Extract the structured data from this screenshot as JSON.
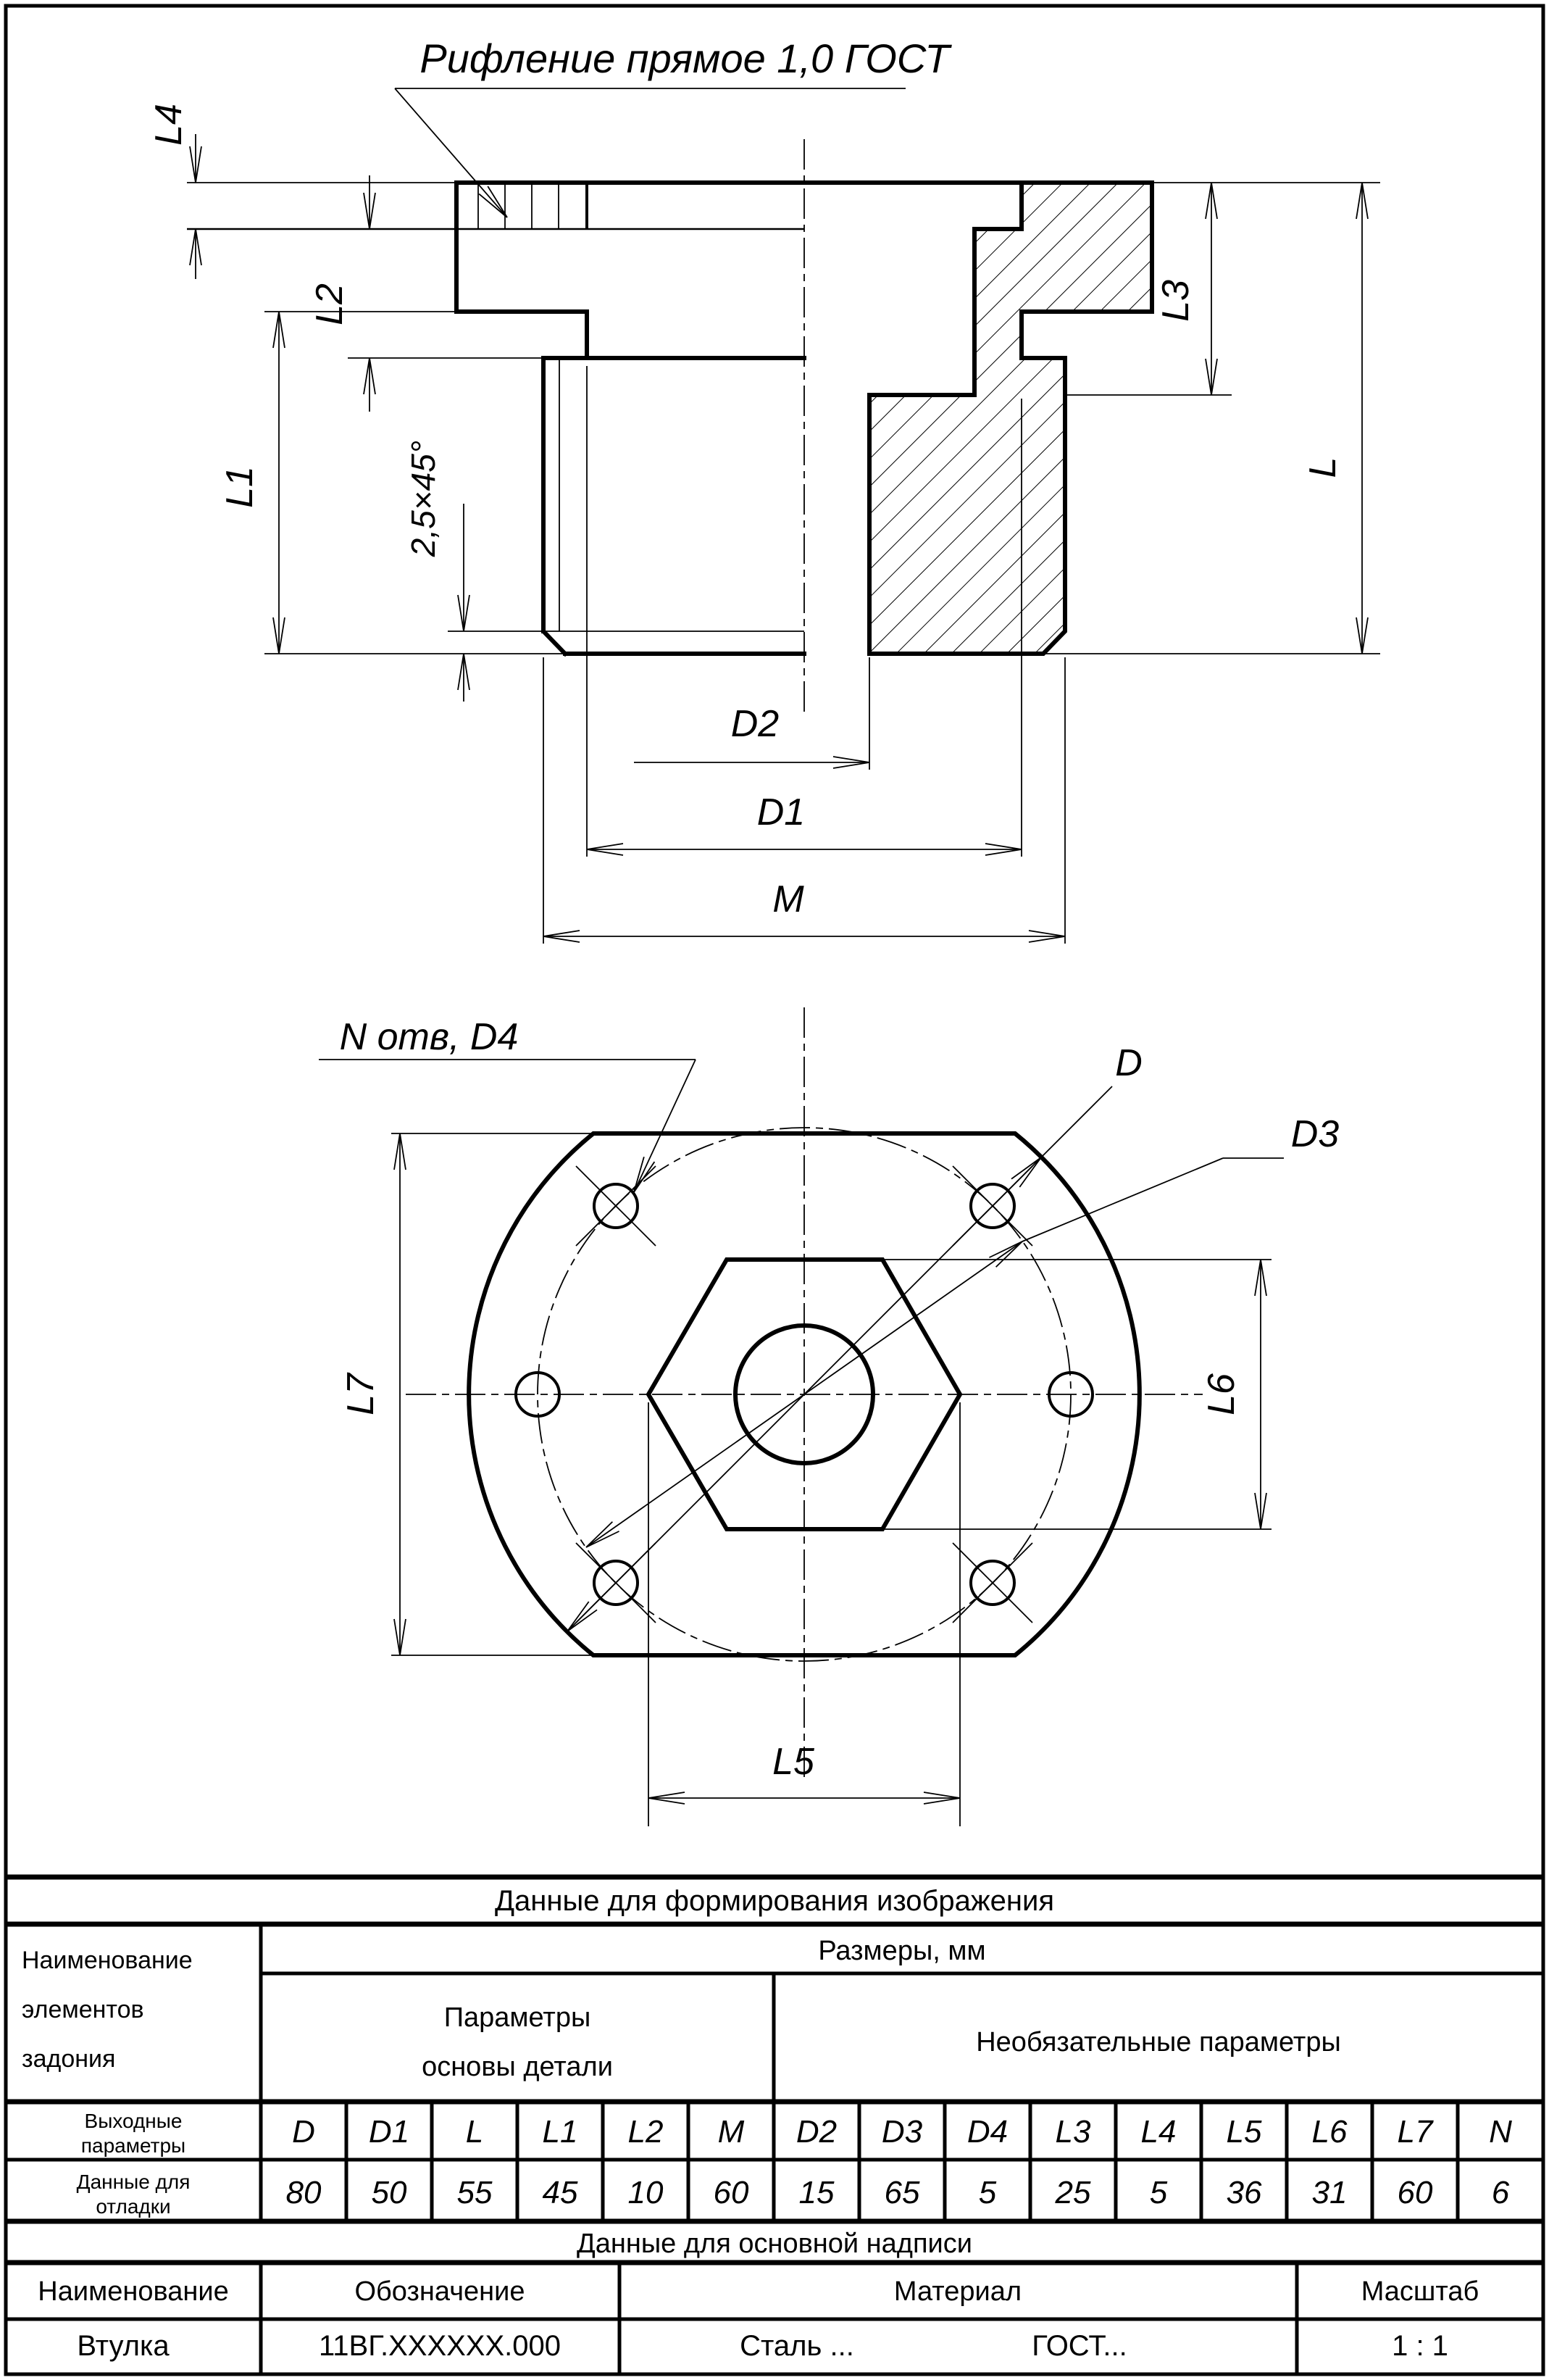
{
  "front_view": {
    "knurl_note": "Рифление прямое 1,0 ГОСТ",
    "labels": {
      "l4": "L4",
      "l2": "L2",
      "l1": "L1",
      "chamfer": "2,5×45°",
      "l3": "L3",
      "l": "L",
      "d2": "D2",
      "d1": "D1",
      "m": "M"
    }
  },
  "bottom_view": {
    "labels": {
      "holes": "N отв, D4",
      "d": "D",
      "d3": "D3",
      "l7": "L7",
      "l6": "L6",
      "l5": "L5"
    }
  },
  "table": {
    "title": "Данные для формирования изображения",
    "left_header_lines": [
      "Наименование",
      "элементов",
      "задония"
    ],
    "sizes_header": "Размеры, мм",
    "base_params_lines": [
      "Параметры",
      "основы детали"
    ],
    "optional_params": "Необязательные параметры",
    "output_row_lines": [
      "Выходные",
      "параметры"
    ],
    "debug_row_lines": [
      "Данные для",
      "отладки"
    ],
    "columns": [
      "D",
      "D1",
      "L",
      "L1",
      "L2",
      "M",
      "D2",
      "D3",
      "D4",
      "L3",
      "L4",
      "L5",
      "L6",
      "L7",
      "N"
    ],
    "values": [
      "80",
      "50",
      "55",
      "45",
      "10",
      "60",
      "15",
      "65",
      "5",
      "25",
      "5",
      "36",
      "31",
      "60",
      "6"
    ]
  },
  "title_block": {
    "section_title": "Данные для основной надписи",
    "name_header": "Наименование",
    "designation_header": "Обозначение",
    "material_header": "Материал",
    "scale_header": "Масштаб",
    "name": "Втулка",
    "designation": "11ВГ.XXXXXX.000",
    "material": "Сталь ...",
    "gost": "ГОСТ...",
    "scale": "1 : 1"
  }
}
